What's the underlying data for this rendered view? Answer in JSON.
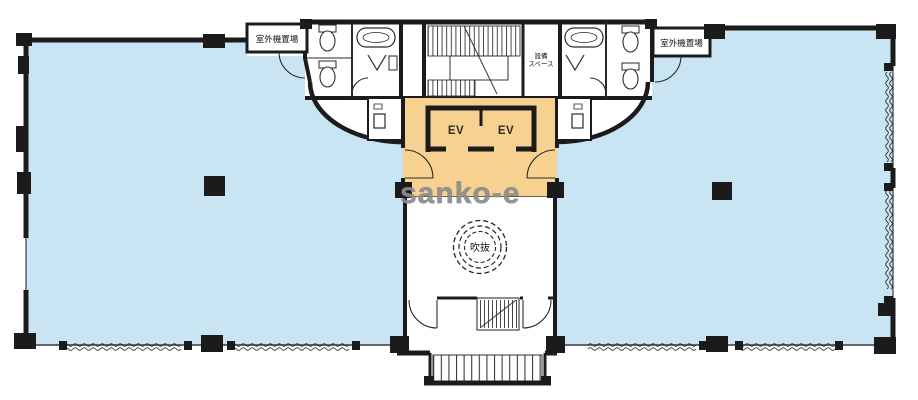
{
  "floorplan": {
    "watermark": "sanko-e",
    "labels": {
      "outdoor_unit_left": "室外機置場",
      "outdoor_unit_right": "室外機置場",
      "equipment_space_line1": "設備",
      "equipment_space_line2": "スペース",
      "elevators": [
        "EV",
        "EV"
      ],
      "atrium": "吹抜"
    },
    "colors": {
      "office_floor_blue": "#c9e4f3",
      "elevator_hall_orange": "#f6d190",
      "wall_black": "#1b1b1b",
      "watermark_gray": "#8d8d8d",
      "background": "#ffffff"
    }
  }
}
